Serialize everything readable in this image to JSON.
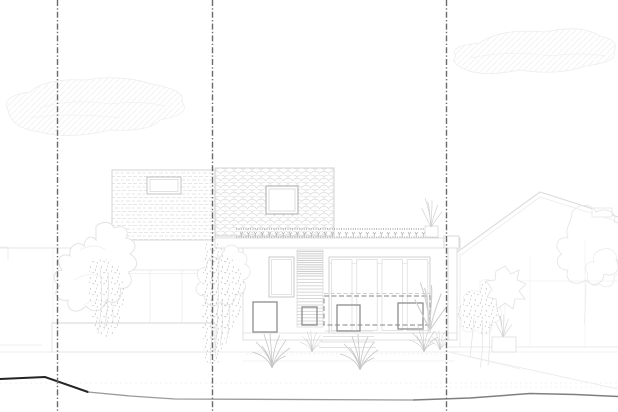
{
  "canvas": {
    "width": 618,
    "height": 412,
    "background": "#ffffff"
  },
  "colors": {
    "boundary": "#6a6a6a",
    "sketch_faint": "#f0f0f0",
    "sketch_light": "#e3e3e3",
    "sketch_mid": "#cdcdcd",
    "frame": "#c3c3c3",
    "marker": "#8d8d8d",
    "dashed_zone": "#9c9c9c",
    "ground_dark": "#242424",
    "ground_mid": "#9a9a9a",
    "ground_right": "#7f7f7f",
    "vegetation": "#e1e1e1",
    "vegetation_speckle": "#c7c7c7",
    "roof_planting": "#a5a5a5"
  },
  "site": {
    "boundary_style": "dash-dot",
    "boundary_lines_x": [
      57.5,
      212.5,
      446.5
    ],
    "level_line_y": 383,
    "ground_profile": {
      "dark_segment_points": "0,379 45,377 88,392",
      "mid_segment_points": "88,392 130,396 175,399 413,400",
      "right_segment_points": "413,400 470,398 530,393.5 575,394.5 618,396.5"
    }
  },
  "house": {
    "upper_floor": {
      "cladding_left": "brick",
      "cladding_right": "fish-scale-tile",
      "window_count": 2
    },
    "green_roof": true,
    "ground_floor": {
      "door_panels": 4,
      "window_count": 1,
      "louver_panel": true
    },
    "dashed_zone": {
      "x": 324,
      "y": 296,
      "w": 106,
      "h": 29
    },
    "proposed_markers": [
      {
        "x": 253,
        "y": 302,
        "w": 24,
        "h": 30
      },
      {
        "x": 302,
        "y": 307,
        "w": 15,
        "h": 18
      },
      {
        "x": 337,
        "y": 305,
        "w": 23,
        "h": 26
      },
      {
        "x": 398,
        "y": 303,
        "w": 25,
        "h": 26
      }
    ]
  }
}
